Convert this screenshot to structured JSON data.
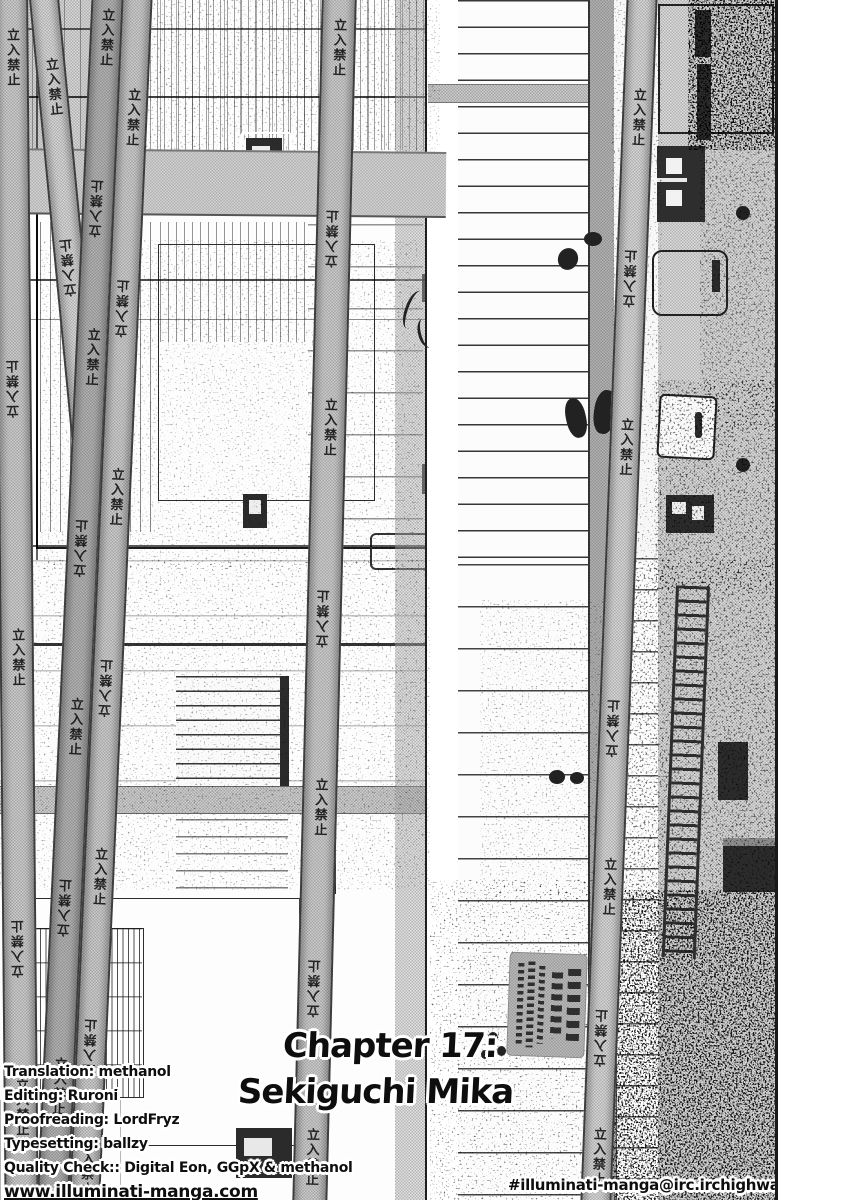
{
  "artwork": {
    "tape_text": "立入禁止"
  },
  "title": {
    "line1": "Chapter 17:",
    "line2": "Sekiguchi Mika"
  },
  "credits": {
    "lines": [
      "Translation: methanol",
      "Editing: Ruroni",
      "Proofreading: LordFryz",
      "Typesetting: ballzy",
      "Quality Check:: Digital Eon, GGpX & methanol"
    ],
    "website": "www.illuminati-manga.com",
    "irc_channel": "#illuminati-manga@irc.irchighway.net"
  },
  "colors": {
    "ink": "#1b1b1b",
    "tape_gray": "#cfcfcf",
    "tone_gray": "#c4c4c4",
    "paper": "#ffffff"
  }
}
